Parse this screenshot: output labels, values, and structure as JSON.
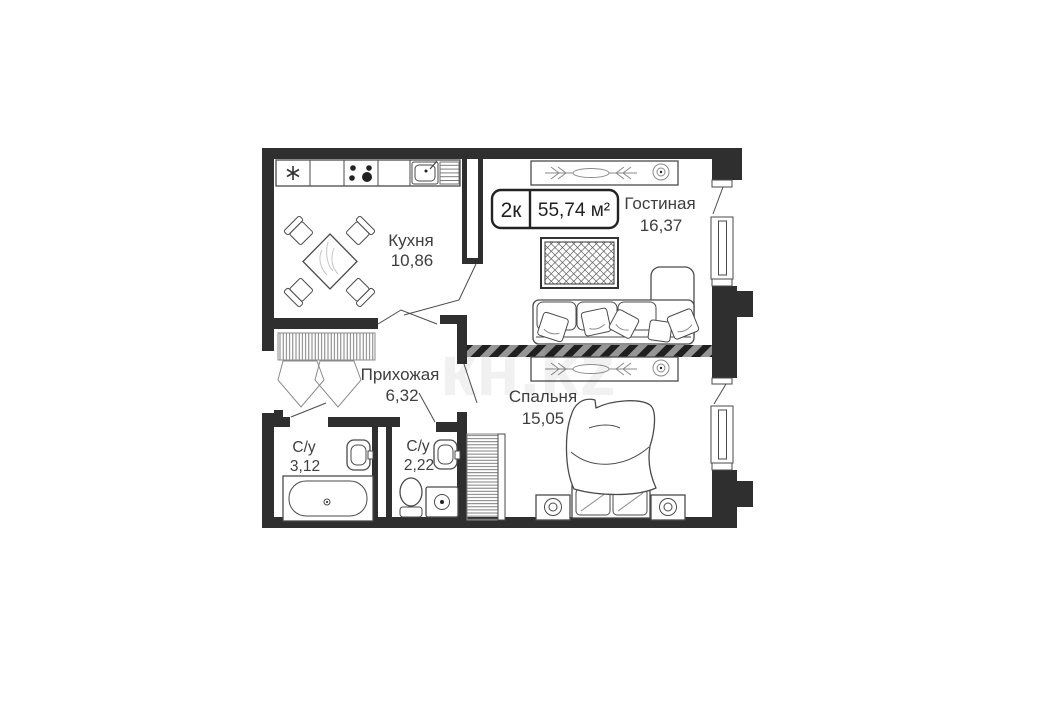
{
  "plan": {
    "badge": {
      "type": "2к",
      "area": "55,74 м²"
    },
    "rooms": {
      "kitchen": {
        "name": "Кухня",
        "area": "10,86"
      },
      "living": {
        "name": "Гостиная",
        "area": "16,37"
      },
      "hallway": {
        "name": "Прихожая",
        "area": "6,32"
      },
      "bedroom": {
        "name": "Спальня",
        "area": "15,05"
      },
      "bathroom1": {
        "name": "С/у",
        "area": "3,12"
      },
      "bathroom2": {
        "name": "С/у",
        "area": "2,22"
      }
    },
    "watermark": "кн.kz"
  },
  "colors": {
    "wall": "#2f2f2f",
    "line": "#4a4a4a",
    "text": "#3e3e3e",
    "stripe_bg": "#969696",
    "stripe_fg": "#1f1f1f",
    "hatch": "#6f6f6f"
  }
}
